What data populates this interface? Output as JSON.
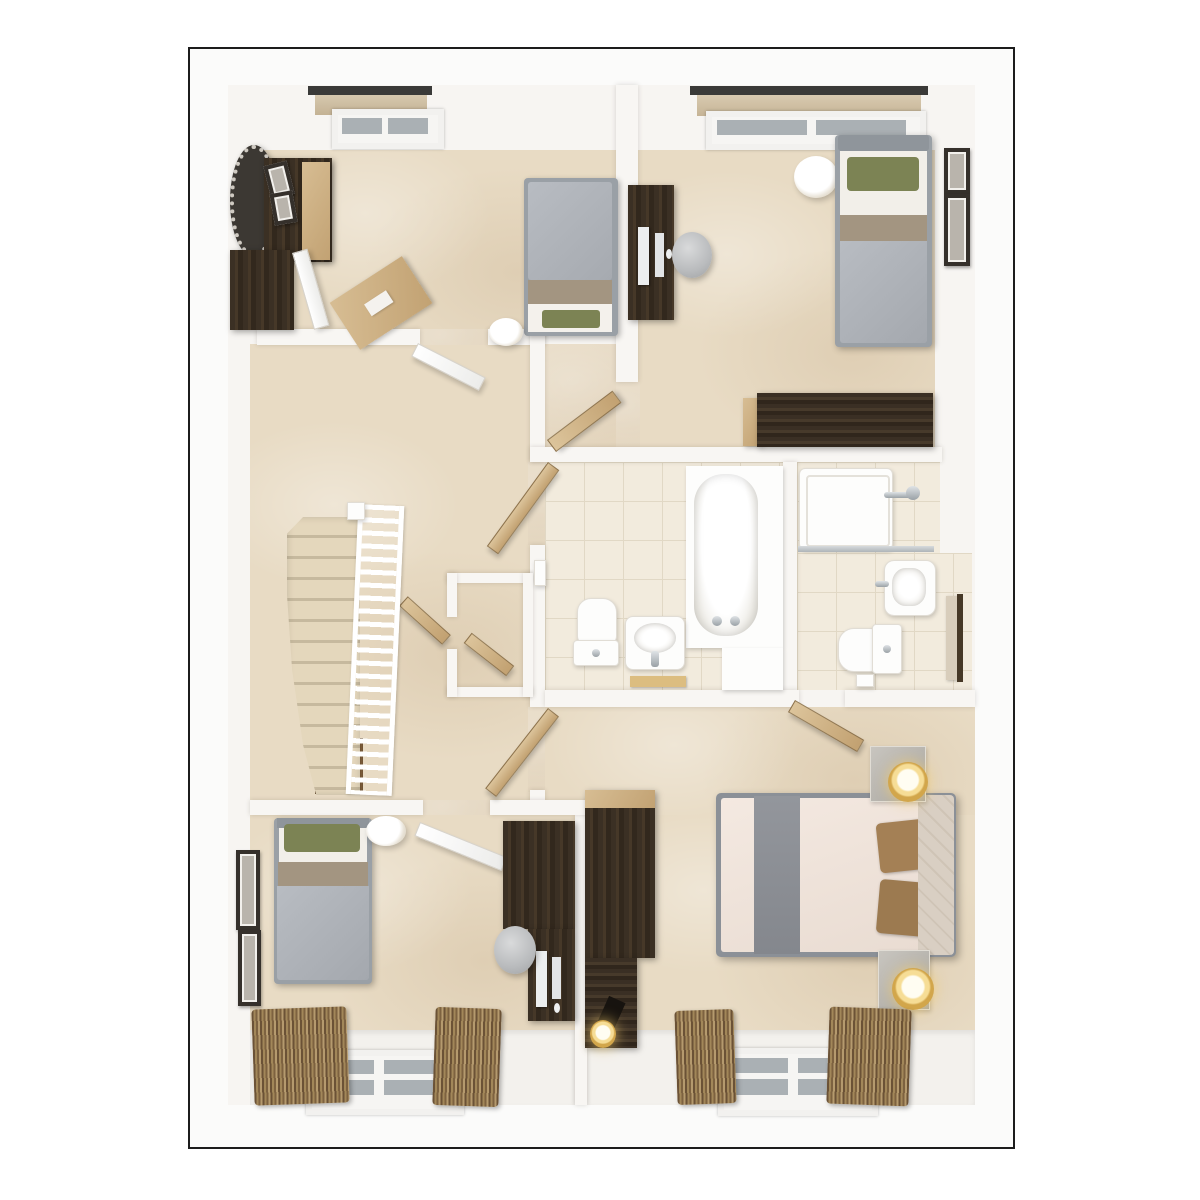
{
  "scene": {
    "kind": "3d-rendered-floor-plan-top-view",
    "floor_label": "",
    "visible_text": "none"
  },
  "palette": {
    "background": "#ffffff",
    "outline": "#1c1c1c",
    "wall_white": "#f7f5f2",
    "carpet_beige": "#e8dbc4",
    "tile_cream": "#f2ebdd",
    "wood_dark": "#3b3024",
    "wood_light": "#cfb285",
    "duvet_gray": "#b0b4ba",
    "blanket_tan": "#a39581",
    "pillow_green": "#7c8354",
    "master_duvet_cream": "#f0e4da",
    "master_pillow_tan": "#a48055",
    "lamp_gold": "#d2a64b",
    "glass_gray": "#aab0b4"
  },
  "rooms": [
    {
      "name": "bedroom-top-left",
      "furniture": [
        "round-mirror",
        "wardrobe",
        "dresser-with-open-door",
        "desk-angled",
        "single-bed",
        "floor-lamp",
        "roof-window"
      ]
    },
    {
      "name": "bedroom-top-right",
      "furniture": [
        "desk-with-computer",
        "desk-chair",
        "single-bed-green-pillow",
        "side-lamp",
        "long-dresser",
        "two-wall-frames",
        "window-with-curtain"
      ]
    },
    {
      "name": "landing",
      "furniture": [
        "staircase",
        "banister",
        "airing-cupboard",
        "cupboard-door"
      ]
    },
    {
      "name": "family-bathroom",
      "furniture": [
        "bathtub",
        "toilet",
        "basin",
        "bath-mat",
        "door"
      ]
    },
    {
      "name": "en-suite",
      "furniture": [
        "shower",
        "glass-screen",
        "basin",
        "toilet",
        "towel-rail",
        "door"
      ]
    },
    {
      "name": "bedroom-bottom-left",
      "furniture": [
        "single-bed-green-pillow",
        "floor-lamp",
        "two-wall-frames",
        "wardrobe",
        "desk-with-computer",
        "desk-chair",
        "window",
        "curtains"
      ]
    },
    {
      "name": "master-bedroom",
      "furniture": [
        "double-bed",
        "two-nightstands",
        "two-gold-lamps",
        "wardrobe",
        "desk-with-lamp",
        "window",
        "curtains"
      ]
    }
  ]
}
